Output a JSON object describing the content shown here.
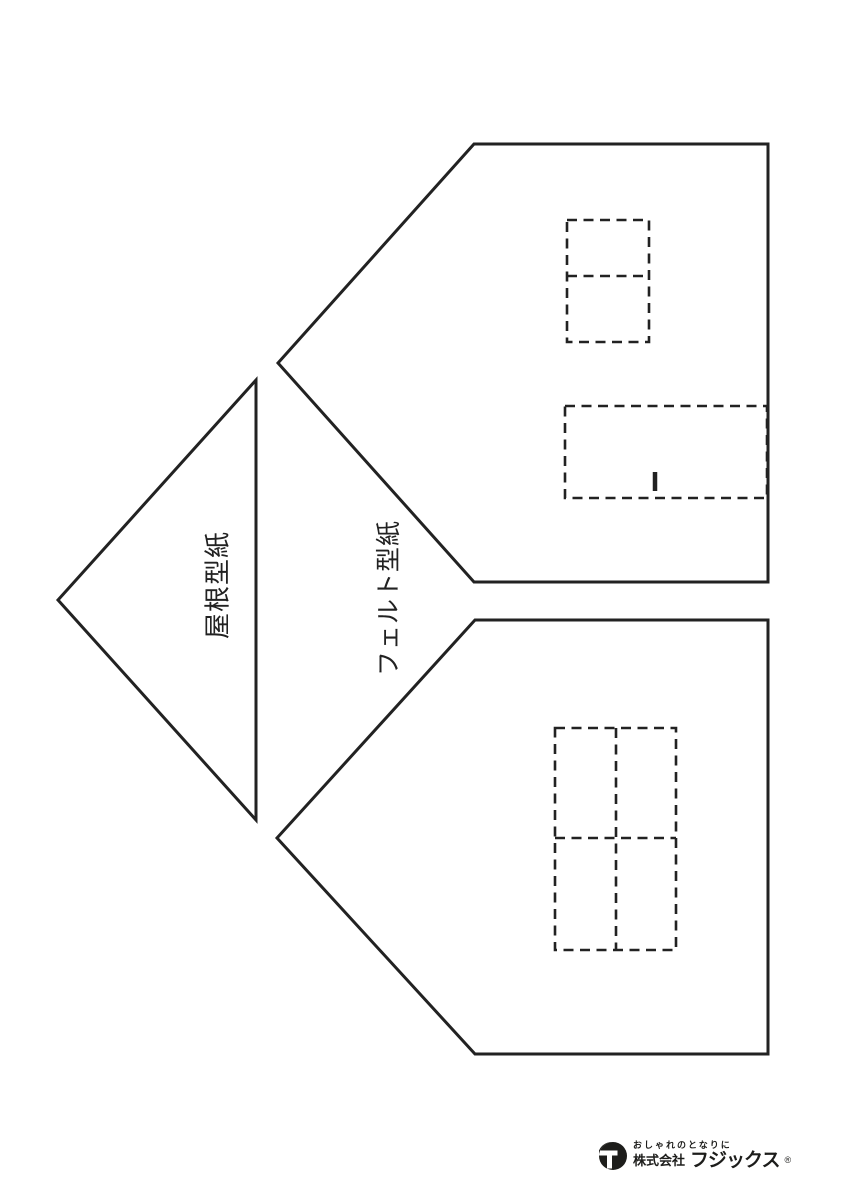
{
  "page": {
    "background_color": "#ffffff",
    "ink_color": "#222222",
    "kind": "sewing pattern template sheet"
  },
  "labels": {
    "roof": "屋根型紙",
    "felt": "フェルト型紙"
  },
  "shapes": {
    "roof_triangle": "roof pattern piece (triangle, point left)",
    "felt_house_top": "felt pattern piece (house pentagon, peak left)",
    "felt_house_bottom": "felt pattern piece (house pentagon, peak left)",
    "chimney_guide": "dashed rectangle with center divider",
    "door_guide": "dashed rectangle with center tick mark",
    "window_guide": "dashed four-pane window grid"
  },
  "logo": {
    "tagline": "おしゃれのとなりに",
    "company": "株式会社",
    "brand": "フジックス",
    "registered_mark": "®",
    "color": "#1d1d1b"
  }
}
